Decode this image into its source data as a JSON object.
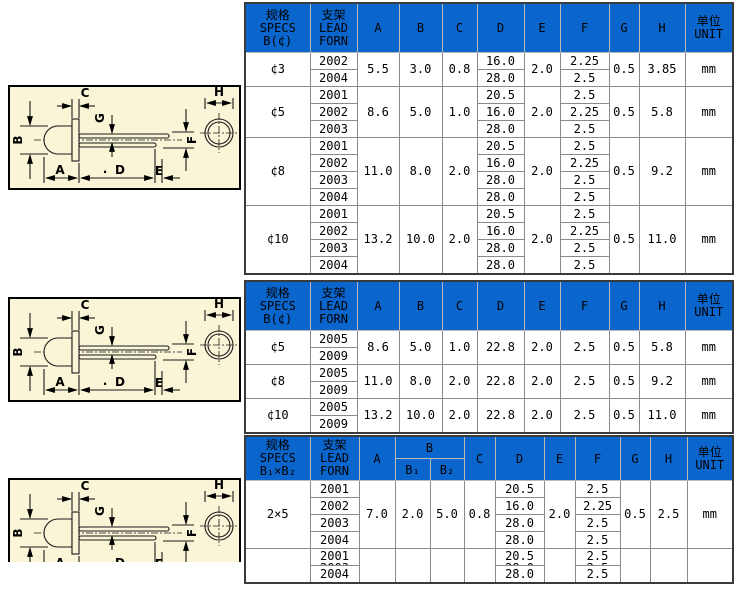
{
  "colors": {
    "page": "#ffffff",
    "blue": "#0a66cc",
    "cream": "#faf5d7",
    "grid": "#8a8a8a",
    "outer": "#3a3a3a",
    "hgrid": "#b9b9b9",
    "ink": "#000000"
  },
  "diagram": {
    "labels": {
      "A": "A",
      "B": "B",
      "C": "C",
      "D": "D",
      "E": "E",
      "F": "F",
      "G": "G",
      "H": "H",
      "dot": "·"
    }
  },
  "tables": [
    {
      "header": {
        "b_split": false,
        "spec_lines": [
          "规格",
          "SPECS",
          "B(¢)"
        ],
        "lead_lines": [
          "支架",
          "LEAD",
          "FORN"
        ],
        "dims": [
          "A",
          "B",
          "C",
          "D",
          "E",
          "F",
          "G",
          "H"
        ],
        "unit_lines": [
          "单位",
          "UNIT"
        ]
      },
      "groups": [
        {
          "spec": "¢3",
          "A": "5.5",
          "B": "3.0",
          "C": "0.8",
          "E": "2.0",
          "G": "0.5",
          "H": "3.85",
          "unit": "mm",
          "rows": [
            {
              "lead": "2002",
              "D": "16.0",
              "F": "2.25"
            },
            {
              "lead": "2004",
              "D": "28.0",
              "F": "2.5"
            }
          ]
        },
        {
          "spec": "¢5",
          "A": "8.6",
          "B": "5.0",
          "C": "1.0",
          "E": "2.0",
          "G": "0.5",
          "H": "5.8",
          "unit": "mm",
          "rows": [
            {
              "lead": "2001",
              "D": "20.5",
              "F": "2.5"
            },
            {
              "lead": "2002",
              "D": "16.0",
              "F": "2.25"
            },
            {
              "lead": "2003",
              "D": "28.0",
              "F": "2.5"
            }
          ]
        },
        {
          "spec": "¢8",
          "A": "11.0",
          "B": "8.0",
          "C": "2.0",
          "E": "2.0",
          "G": "0.5",
          "H": "9.2",
          "unit": "mm",
          "rows": [
            {
              "lead": "2001",
              "D": "20.5",
              "F": "2.5"
            },
            {
              "lead": "2002",
              "D": "16.0",
              "F": "2.25"
            },
            {
              "lead": "2003",
              "D": "28.0",
              "F": "2.5"
            },
            {
              "lead": "2004",
              "D": "28.0",
              "F": "2.5"
            }
          ]
        },
        {
          "spec": "¢10",
          "A": "13.2",
          "B": "10.0",
          "C": "2.0",
          "E": "2.0",
          "G": "0.5",
          "H": "11.0",
          "unit": "mm",
          "rows": [
            {
              "lead": "2001",
              "D": "20.5",
              "F": "2.5"
            },
            {
              "lead": "2002",
              "D": "16.0",
              "F": "2.25"
            },
            {
              "lead": "2003",
              "D": "28.0",
              "F": "2.5"
            },
            {
              "lead": "2004",
              "D": "28.0",
              "F": "2.5"
            }
          ]
        }
      ]
    },
    {
      "header": {
        "b_split": false,
        "spec_lines": [
          "规格",
          "SPECS",
          "B(¢)"
        ],
        "lead_lines": [
          "支架",
          "LEAD",
          "FORN"
        ],
        "dims": [
          "A",
          "B",
          "C",
          "D",
          "E",
          "F",
          "G",
          "H"
        ],
        "unit_lines": [
          "单位",
          "UNIT"
        ]
      },
      "groups": [
        {
          "spec": "¢5",
          "A": "8.6",
          "B": "5.0",
          "C": "1.0",
          "D": "22.8",
          "E": "2.0",
          "F": "2.5",
          "G": "0.5",
          "H": "5.8",
          "unit": "mm",
          "rows": [
            {
              "lead": "2005"
            },
            {
              "lead": "2009"
            }
          ]
        },
        {
          "spec": "¢8",
          "A": "11.0",
          "B": "8.0",
          "C": "2.0",
          "D": "22.8",
          "E": "2.0",
          "F": "2.5",
          "G": "0.5",
          "H": "9.2",
          "unit": "mm",
          "rows": [
            {
              "lead": "2005"
            },
            {
              "lead": "2009"
            }
          ]
        },
        {
          "spec": "¢10",
          "A": "13.2",
          "B": "10.0",
          "C": "2.0",
          "D": "22.8",
          "E": "2.0",
          "F": "2.5",
          "G": "0.5",
          "H": "11.0",
          "unit": "mm",
          "rows": [
            {
              "lead": "2005"
            },
            {
              "lead": "2009"
            }
          ]
        }
      ]
    },
    {
      "header": {
        "b_split": true,
        "spec_lines": [
          "规格",
          "SPECS",
          "B₁×B₂"
        ],
        "lead_lines": [
          "支架",
          "LEAD",
          "FORN"
        ],
        "dims": [
          "A",
          "B",
          "C",
          "D",
          "E",
          "F",
          "G",
          "H"
        ],
        "b_sub": [
          "B₁",
          "B₂"
        ],
        "unit_lines": [
          "单位",
          "UNIT"
        ]
      },
      "groups": [
        {
          "spec": "2×5",
          "A": "7.0",
          "B1": "2.0",
          "B2": "5.0",
          "C": "0.8",
          "E": "2.0",
          "G": "0.5",
          "H": "2.5",
          "unit": "mm",
          "rows": [
            {
              "lead": "2001",
              "D": "20.5",
              "F": "2.5"
            },
            {
              "lead": "2002",
              "D": "16.0",
              "F": "2.25"
            },
            {
              "lead": "2003",
              "D": "28.0",
              "F": "2.5"
            },
            {
              "lead": "2004",
              "D": "28.0",
              "F": "2.5"
            }
          ]
        },
        {
          "spec": "",
          "A": "",
          "B1": "",
          "B2": "",
          "C": "",
          "E": "",
          "G": "",
          "H": "",
          "unit": "",
          "rows": [
            {
              "lead": "2001",
              "lead2": "2003",
              "D": "20.5",
              "D2": "28.0",
              "F": "2.5",
              "F2": "2.5"
            },
            {
              "lead": "2004",
              "D": "28.0",
              "F": "2.5"
            }
          ]
        }
      ]
    }
  ]
}
